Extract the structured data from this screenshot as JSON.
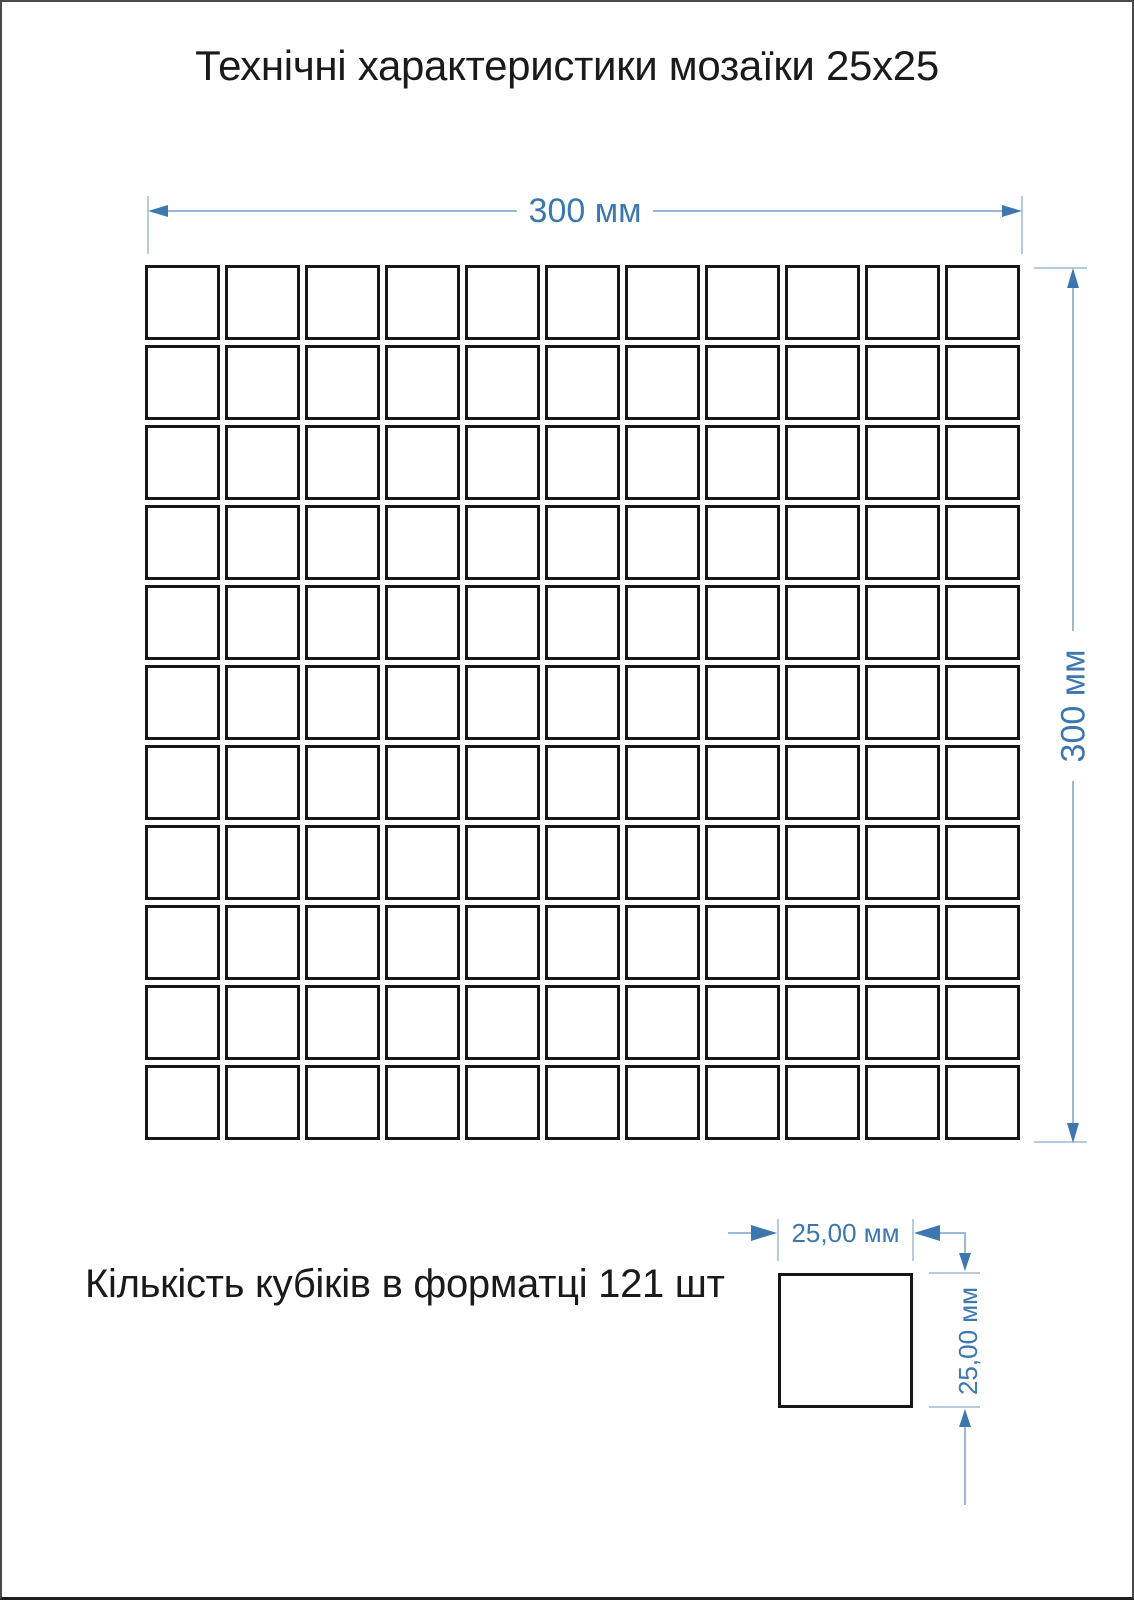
{
  "title": "Технічні характеристики мозаїки 25х25",
  "sheet": {
    "width_label": "300 мм",
    "height_label": "300 мм",
    "grid": {
      "rows": 11,
      "cols": 11,
      "tile_count": 121
    }
  },
  "note": "Кількість кубіків в форматці 121 шт",
  "tile": {
    "width_label": "25,00 мм",
    "height_label": "25,00 мм"
  },
  "colors": {
    "accent": "#3d77b0",
    "line": "#9cb8d6",
    "tick": "#b7cce0",
    "ink": "#1a1a1a",
    "tile_border": "#161616",
    "page_border": "#4a4a4a"
  }
}
